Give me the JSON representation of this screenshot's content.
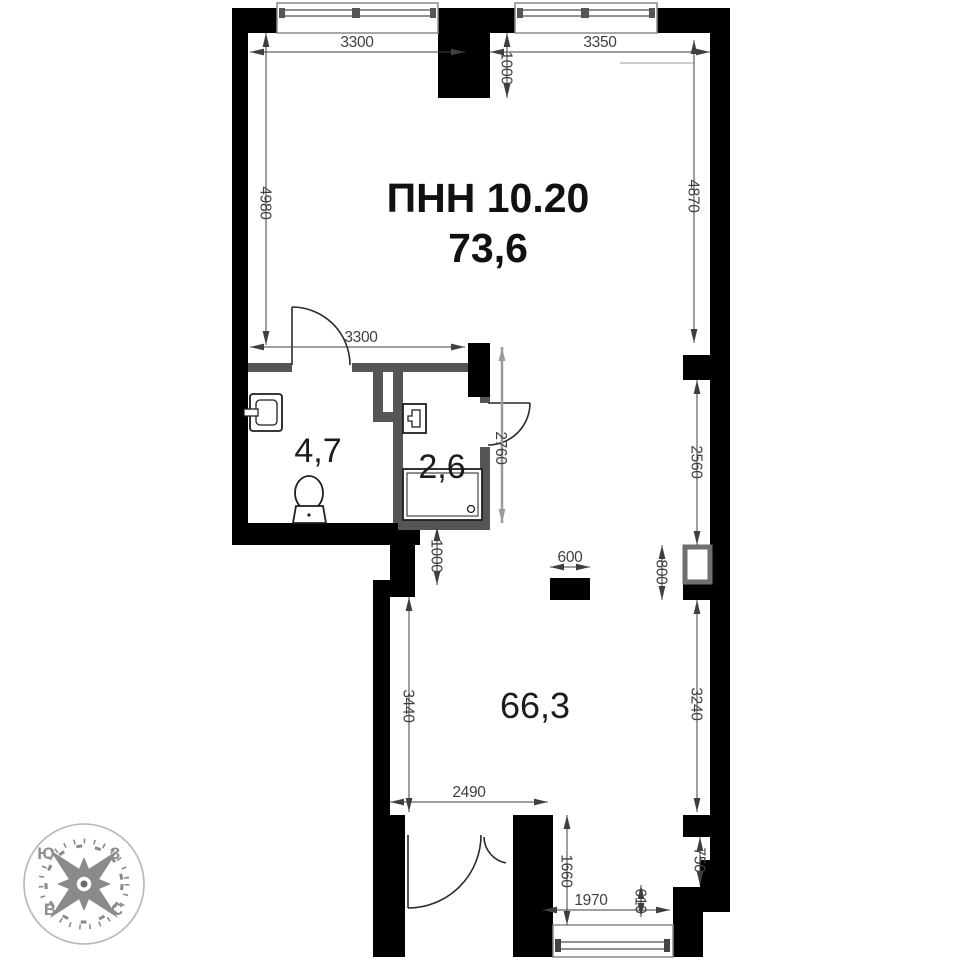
{
  "unit": {
    "label": "ПНН 10.20",
    "area": "73,6"
  },
  "rooms": {
    "bath": "4,7",
    "shower": "2,6",
    "main": "66,3"
  },
  "dims": {
    "w3300_top": "3300",
    "p1000_top": "1000",
    "w3350_top": "3350",
    "h4980": "4980",
    "h4870": "4870",
    "w3300_mid": "3300",
    "h2760": "2760",
    "h2560": "2560",
    "h800": "800",
    "w600": "600",
    "h1000_low": "1000",
    "h3440": "3440",
    "h3240": "3240",
    "w2490": "2490",
    "h1660": "1660",
    "w1970": "1970",
    "h610": "610",
    "h750": "750"
  },
  "compass": {
    "south": "Ю",
    "west": "З",
    "east": "В",
    "north": "С"
  },
  "colors": {
    "wall": "#000000",
    "partition": "#555555",
    "dimension": "#3f3f3f",
    "compass": "#8a8a8a",
    "window_frame": "#8a8a8a"
  }
}
